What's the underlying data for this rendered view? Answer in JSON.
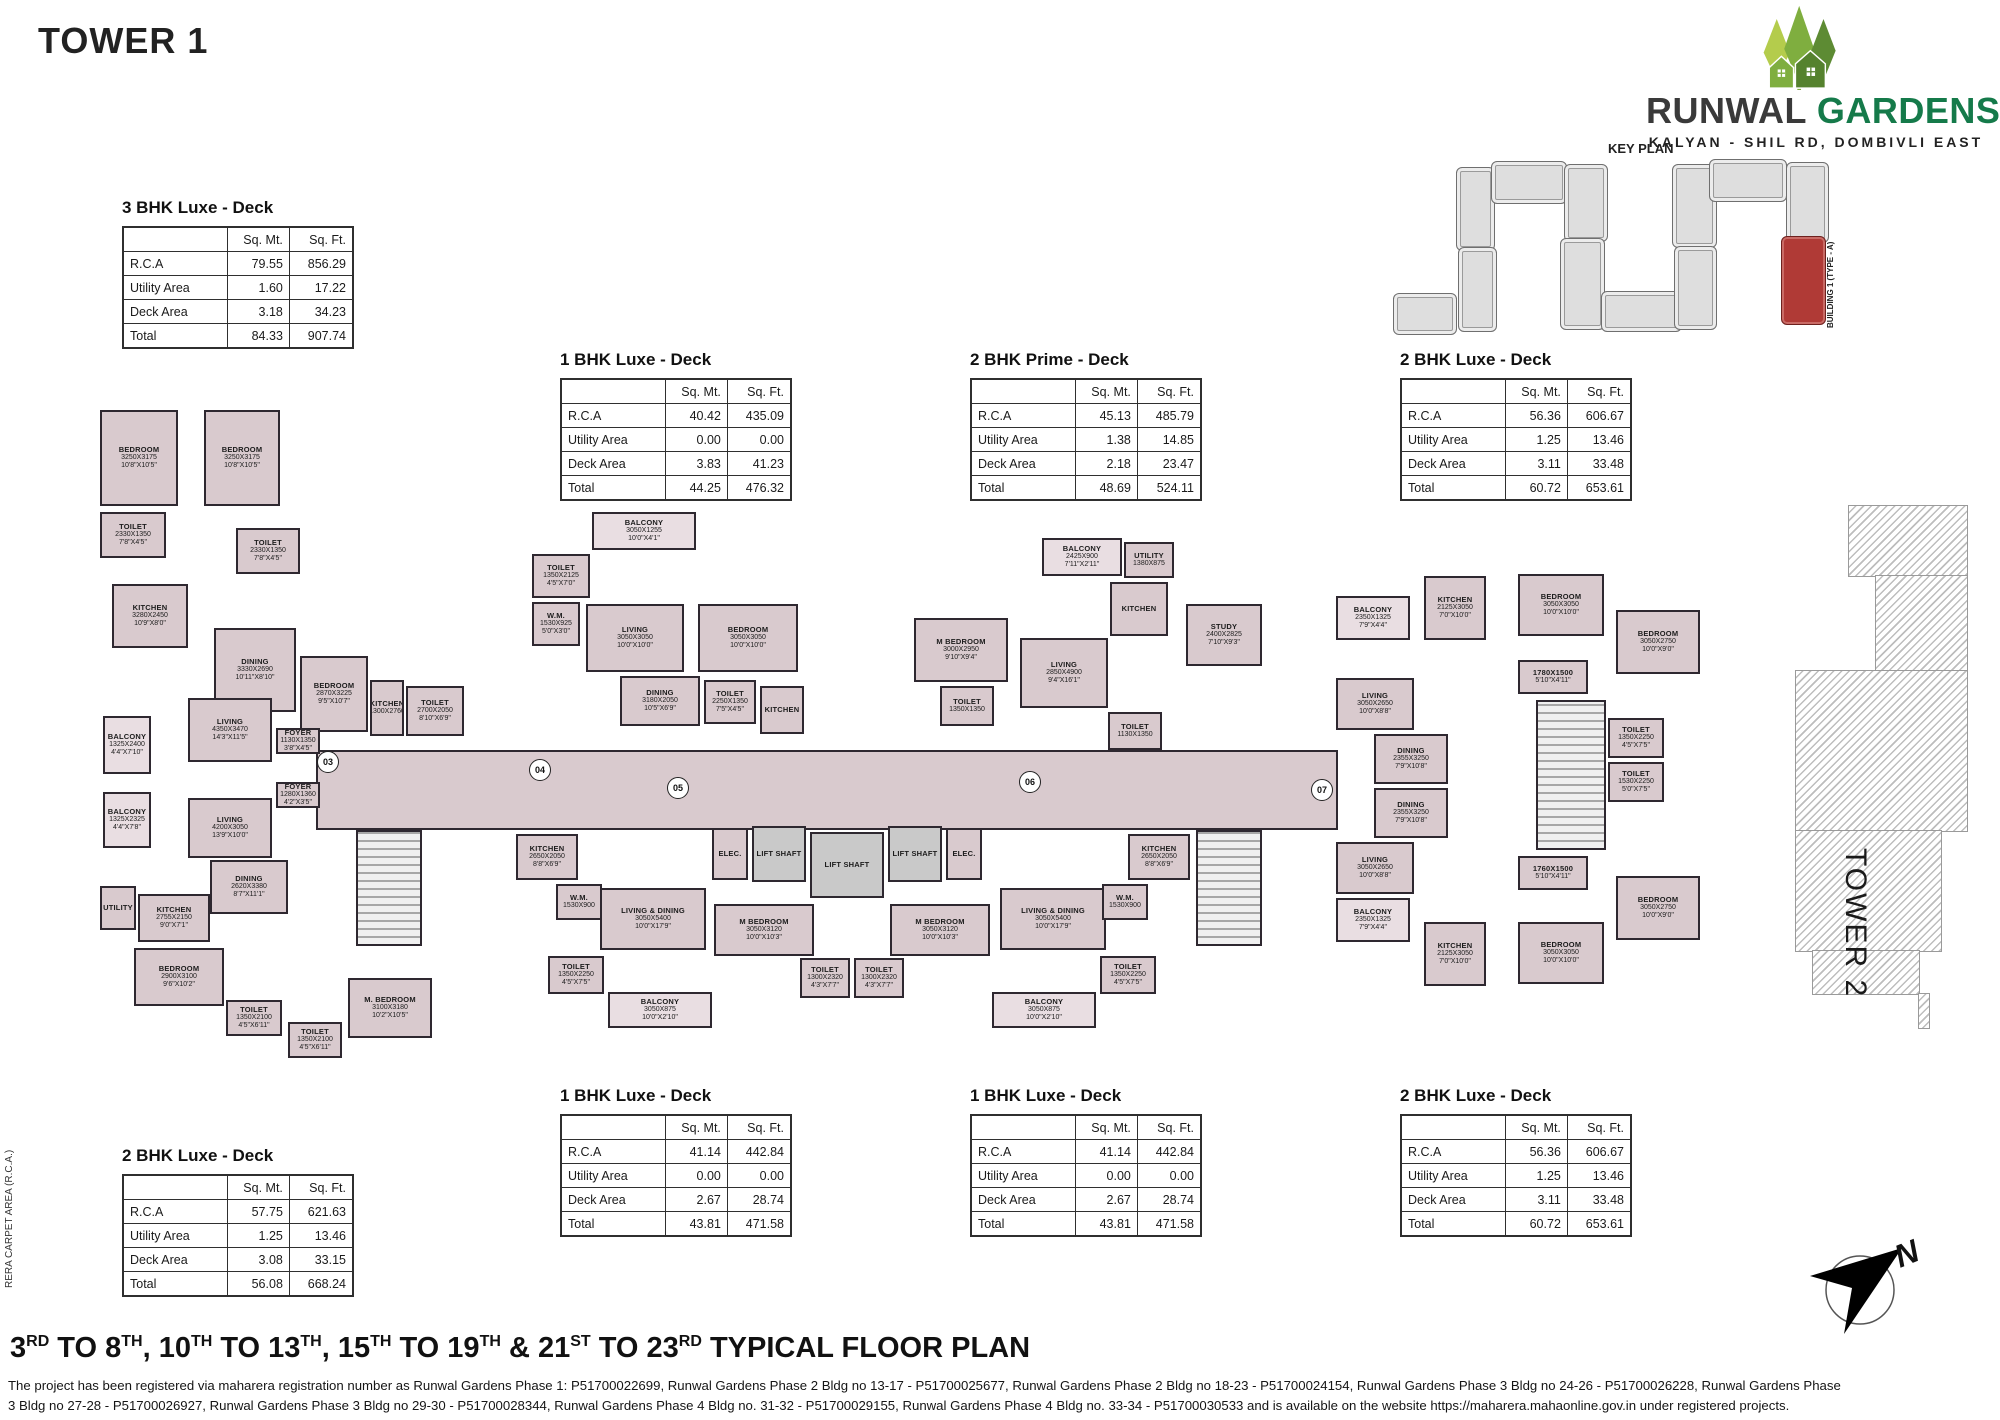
{
  "page": {
    "title": "TOWER 1"
  },
  "brand": {
    "name_primary": "RUNWAL",
    "name_secondary": "GARDENS",
    "tagline": "KALYAN - SHIL RD, DOMBIVLI EAST",
    "colors": {
      "primary_text": "#3a3a3a",
      "secondary_text": "#157a4a",
      "tree_light": "#b4cc4c",
      "tree_mid": "#7fae3f",
      "tree_dark": "#5d8b33"
    }
  },
  "key_plan": {
    "label": "KEY PLAN",
    "building_label": "BUILDING 1 (TYPE - A)",
    "highlight_color": "#b03a36",
    "blocks": [
      {
        "x": 1393,
        "y": 293,
        "w": 62,
        "h": 40
      },
      {
        "x": 1456,
        "y": 167,
        "w": 37,
        "h": 82
      },
      {
        "x": 1458,
        "y": 247,
        "w": 37,
        "h": 83
      },
      {
        "x": 1491,
        "y": 161,
        "w": 74,
        "h": 41
      },
      {
        "x": 1564,
        "y": 164,
        "w": 42,
        "h": 76
      },
      {
        "x": 1560,
        "y": 238,
        "w": 43,
        "h": 90
      },
      {
        "x": 1601,
        "y": 291,
        "w": 79,
        "h": 39
      },
      {
        "x": 1672,
        "y": 164,
        "w": 43,
        "h": 82
      },
      {
        "x": 1674,
        "y": 246,
        "w": 41,
        "h": 82
      },
      {
        "x": 1709,
        "y": 159,
        "w": 76,
        "h": 41
      },
      {
        "x": 1786,
        "y": 162,
        "w": 41,
        "h": 79
      },
      {
        "x": 1781,
        "y": 236,
        "w": 43,
        "h": 87,
        "red": true
      }
    ]
  },
  "tables": [
    {
      "title": "3 BHK Luxe - Deck",
      "headers": [
        "",
        "Sq. Mt.",
        "Sq. Ft."
      ],
      "rows": [
        [
          "R.C.A",
          "79.55",
          "856.29"
        ],
        [
          "Utility Area",
          "1.60",
          "17.22"
        ],
        [
          "Deck Area",
          "3.18",
          "34.23"
        ],
        [
          "Total",
          "84.33",
          "907.74"
        ]
      ]
    },
    {
      "title": "1 BHK Luxe - Deck",
      "headers": [
        "",
        "Sq. Mt.",
        "Sq. Ft."
      ],
      "rows": [
        [
          "R.C.A",
          "40.42",
          "435.09"
        ],
        [
          "Utility Area",
          "0.00",
          "0.00"
        ],
        [
          "Deck Area",
          "3.83",
          "41.23"
        ],
        [
          "Total",
          "44.25",
          "476.32"
        ]
      ]
    },
    {
      "title": "2 BHK Prime - Deck",
      "headers": [
        "",
        "Sq. Mt.",
        "Sq. Ft."
      ],
      "rows": [
        [
          "R.C.A",
          "45.13",
          "485.79"
        ],
        [
          "Utility Area",
          "1.38",
          "14.85"
        ],
        [
          "Deck Area",
          "2.18",
          "23.47"
        ],
        [
          "Total",
          "48.69",
          "524.11"
        ]
      ]
    },
    {
      "title": "2 BHK Luxe - Deck",
      "headers": [
        "",
        "Sq. Mt.",
        "Sq. Ft."
      ],
      "rows": [
        [
          "R.C.A",
          "56.36",
          "606.67"
        ],
        [
          "Utility Area",
          "1.25",
          "13.46"
        ],
        [
          "Deck Area",
          "3.11",
          "33.48"
        ],
        [
          "Total",
          "60.72",
          "653.61"
        ]
      ]
    },
    {
      "title": "1 BHK Luxe - Deck",
      "headers": [
        "",
        "Sq. Mt.",
        "Sq. Ft."
      ],
      "rows": [
        [
          "R.C.A",
          "41.14",
          "442.84"
        ],
        [
          "Utility Area",
          "0.00",
          "0.00"
        ],
        [
          "Deck Area",
          "2.67",
          "28.74"
        ],
        [
          "Total",
          "43.81",
          "471.58"
        ]
      ]
    },
    {
      "title": "1 BHK Luxe - Deck",
      "headers": [
        "",
        "Sq. Mt.",
        "Sq. Ft."
      ],
      "rows": [
        [
          "R.C.A",
          "41.14",
          "442.84"
        ],
        [
          "Utility Area",
          "0.00",
          "0.00"
        ],
        [
          "Deck Area",
          "2.67",
          "28.74"
        ],
        [
          "Total",
          "43.81",
          "471.58"
        ]
      ]
    },
    {
      "title": "2 BHK Luxe - Deck",
      "headers": [
        "",
        "Sq. Mt.",
        "Sq. Ft."
      ],
      "rows": [
        [
          "R.C.A",
          "56.36",
          "606.67"
        ],
        [
          "Utility Area",
          "1.25",
          "13.46"
        ],
        [
          "Deck Area",
          "3.11",
          "33.48"
        ],
        [
          "Total",
          "60.72",
          "653.61"
        ]
      ]
    },
    {
      "title": "2 BHK Luxe - Deck",
      "headers": [
        "",
        "Sq. Mt.",
        "Sq. Ft."
      ],
      "rows": [
        [
          "R.C.A",
          "57.75",
          "621.63"
        ],
        [
          "Utility Area",
          "1.25",
          "13.46"
        ],
        [
          "Deck Area",
          "3.08",
          "33.15"
        ],
        [
          "Total",
          "56.08",
          "668.24"
        ]
      ]
    }
  ],
  "floor_plan": {
    "tower2_label": "TOWER 2",
    "rera_note": "RERA CARPET AREA (R.C.A.)",
    "room_fill": "#d9cace",
    "rooms": [
      [
        "",
        "",
        "",
        316,
        750,
        1022,
        80,
        "c"
      ],
      [
        "BEDROOM",
        "3250X3175",
        "10'8\"X10'5\"",
        100,
        410,
        78,
        96,
        "r"
      ],
      [
        "BEDROOM",
        "3250X3175",
        "10'8\"X10'5\"",
        204,
        410,
        76,
        96,
        "r"
      ],
      [
        "TOILET",
        "2330X1350",
        "7'8\"X4'5\"",
        100,
        512,
        66,
        46,
        "r"
      ],
      [
        "TOILET",
        "2330X1350",
        "7'8\"X4'5\"",
        236,
        528,
        64,
        46,
        "r"
      ],
      [
        "KITCHEN",
        "3280X2450",
        "10'9\"X8'0\"",
        112,
        584,
        76,
        64,
        "r"
      ],
      [
        "DINING",
        "3330X2690",
        "10'11\"X8'10\"",
        214,
        628,
        82,
        84,
        "r"
      ],
      [
        "BEDROOM",
        "2870X3225",
        "9'5\"X10'7\"",
        300,
        656,
        68,
        76,
        "r"
      ],
      [
        "KITCHEN",
        "1300X2760",
        "",
        370,
        680,
        34,
        56,
        "r"
      ],
      [
        "TOILET",
        "2700X2050",
        "8'10\"X6'9\"",
        406,
        686,
        58,
        50,
        "r"
      ],
      [
        "BALCONY",
        "1325X2400",
        "4'4\"X7'10\"",
        103,
        716,
        48,
        58,
        "b"
      ],
      [
        "LIVING",
        "4350X3470",
        "14'3\"X11'5\"",
        188,
        698,
        84,
        64,
        "r"
      ],
      [
        "FOYER",
        "1130X1350",
        "3'8\"X4'5\"",
        276,
        728,
        44,
        26,
        "r"
      ],
      [
        "FOYER",
        "1280X1360",
        "4'2\"X3'5\"",
        276,
        782,
        44,
        26,
        "r"
      ],
      [
        "BALCONY",
        "1325X2325",
        "4'4\"X7'8\"",
        103,
        792,
        48,
        56,
        "b"
      ],
      [
        "LIVING",
        "4200X3050",
        "13'9\"X10'0\"",
        188,
        798,
        84,
        60,
        "r"
      ],
      [
        "DINING",
        "2620X3380",
        "8'7\"X11'1\"",
        210,
        860,
        78,
        54,
        "r"
      ],
      [
        "UTILITY",
        "",
        "",
        100,
        886,
        36,
        44,
        "r"
      ],
      [
        "KITCHEN",
        "2755X2150",
        "9'0\"X7'1\"",
        138,
        894,
        72,
        48,
        "r"
      ],
      [
        "BEDROOM",
        "2900X3100",
        "9'6\"X10'2\"",
        134,
        948,
        90,
        58,
        "r"
      ],
      [
        "TOILET",
        "1350X2100",
        "4'5\"X6'11\"",
        226,
        1000,
        56,
        36,
        "r"
      ],
      [
        "TOILET",
        "1350X2100",
        "4'5\"X6'11\"",
        288,
        1022,
        54,
        36,
        "r"
      ],
      [
        "M. BEDROOM",
        "3100X3180",
        "10'2\"X10'5\"",
        348,
        978,
        84,
        60,
        "r"
      ],
      [
        "",
        "",
        "",
        356,
        830,
        66,
        116,
        "s"
      ],
      [
        "BALCONY",
        "3050X1255",
        "10'0\"X4'1\"",
        592,
        512,
        104,
        38,
        "b"
      ],
      [
        "TOILET",
        "1350X2125",
        "4'5\"X7'0\"",
        532,
        554,
        58,
        44,
        "r"
      ],
      [
        "W.M.",
        "1530X925",
        "5'0\"X3'0\"",
        532,
        602,
        48,
        44,
        "r"
      ],
      [
        "LIVING",
        "3050X3050",
        "10'0\"X10'0\"",
        586,
        604,
        98,
        68,
        "r"
      ],
      [
        "BEDROOM",
        "3050X3050",
        "10'0\"X10'0\"",
        698,
        604,
        100,
        68,
        "r"
      ],
      [
        "DINING",
        "3180X2050",
        "10'5\"X6'9\"",
        620,
        676,
        80,
        50,
        "r"
      ],
      [
        "TOILET",
        "2250X1350",
        "7'5\"X4'5\"",
        704,
        680,
        52,
        44,
        "r"
      ],
      [
        "KITCHEN",
        "",
        "",
        760,
        686,
        44,
        48,
        "r"
      ],
      [
        "BALCONY",
        "2425X900",
        "7'11\"X2'11\"",
        1042,
        538,
        80,
        38,
        "b"
      ],
      [
        "UTILITY",
        "1380X875",
        "",
        1124,
        542,
        50,
        36,
        "r"
      ],
      [
        "M BEDROOM",
        "3000X2950",
        "9'10\"X9'4\"",
        914,
        618,
        94,
        64,
        "r"
      ],
      [
        "LIVING",
        "2850X4900",
        "9'4\"X16'1\"",
        1020,
        638,
        88,
        70,
        "r"
      ],
      [
        "KITCHEN",
        "",
        "",
        1110,
        582,
        58,
        54,
        "r"
      ],
      [
        "STUDY",
        "2400X2825",
        "7'10\"X9'3\"",
        1186,
        604,
        76,
        62,
        "r"
      ],
      [
        "TOILET",
        "1350X1350",
        "",
        940,
        686,
        54,
        40,
        "r"
      ],
      [
        "TOILET",
        "1130X1350",
        "",
        1108,
        712,
        54,
        38,
        "r"
      ],
      [
        "BALCONY",
        "2350X1325",
        "7'9\"X4'4\"",
        1336,
        596,
        74,
        44,
        "b"
      ],
      [
        "KITCHEN",
        "2125X3050",
        "7'0\"X10'0\"",
        1424,
        576,
        62,
        64,
        "r"
      ],
      [
        "BEDROOM",
        "3050X3050",
        "10'0\"X10'0\"",
        1518,
        574,
        86,
        62,
        "r"
      ],
      [
        "BEDROOM",
        "3050X2750",
        "10'0\"X9'0\"",
        1616,
        610,
        84,
        64,
        "r"
      ],
      [
        "LIVING",
        "3050X2650",
        "10'0\"X8'8\"",
        1336,
        678,
        78,
        52,
        "r"
      ],
      [
        "DINING",
        "2355X3250",
        "7'9\"X10'8\"",
        1374,
        734,
        74,
        50,
        "r"
      ],
      [
        "1780X1500",
        "",
        "5'10\"X4'11\"",
        1518,
        660,
        70,
        34,
        "r"
      ],
      [
        "TOILET",
        "1350X2250",
        "4'5\"X7'5\"",
        1608,
        718,
        56,
        40,
        "r"
      ],
      [
        "TOILET",
        "1530X2250",
        "5'0\"X7'5\"",
        1608,
        762,
        56,
        40,
        "r"
      ],
      [
        "",
        "",
        "",
        1536,
        700,
        70,
        150,
        "s"
      ],
      [
        "DINING",
        "2355X3250",
        "7'9\"X10'8\"",
        1374,
        788,
        74,
        50,
        "r"
      ],
      [
        "LIVING",
        "3050X2650",
        "10'0\"X8'8\"",
        1336,
        842,
        78,
        52,
        "r"
      ],
      [
        "1760X1500",
        "",
        "5'10\"X4'11\"",
        1518,
        856,
        70,
        34,
        "r"
      ],
      [
        "BEDROOM",
        "3050X2750",
        "10'0\"X9'0\"",
        1616,
        876,
        84,
        64,
        "r"
      ],
      [
        "BALCONY",
        "2350X1325",
        "7'9\"X4'4\"",
        1336,
        898,
        74,
        44,
        "b"
      ],
      [
        "KITCHEN",
        "2125X3050",
        "7'0\"X10'0\"",
        1424,
        922,
        62,
        64,
        "r"
      ],
      [
        "BEDROOM",
        "3050X3050",
        "10'0\"X10'0\"",
        1518,
        922,
        86,
        62,
        "r"
      ],
      [
        "KITCHEN",
        "2650X2050",
        "8'8\"X6'9\"",
        516,
        834,
        62,
        46,
        "r"
      ],
      [
        "ELEC.",
        "",
        "",
        712,
        828,
        36,
        52,
        "r"
      ],
      [
        "LIFT SHAFT",
        "",
        "",
        752,
        826,
        54,
        56,
        "l"
      ],
      [
        "LIFT SHAFT",
        "",
        "",
        810,
        832,
        74,
        66,
        "l"
      ],
      [
        "LIFT SHAFT",
        "",
        "",
        888,
        826,
        54,
        56,
        "l"
      ],
      [
        "ELEC.",
        "",
        "",
        946,
        828,
        36,
        52,
        "r"
      ],
      [
        "W.M.",
        "1530X900",
        "",
        556,
        884,
        46,
        36,
        "r"
      ],
      [
        "LIVING & DINING",
        "3050X5400",
        "10'0\"X17'9\"",
        600,
        888,
        106,
        62,
        "r"
      ],
      [
        "M BEDROOM",
        "3050X3120",
        "10'0\"X10'3\"",
        714,
        904,
        100,
        52,
        "r"
      ],
      [
        "TOILET",
        "1350X2250",
        "4'5\"X7'5\"",
        548,
        956,
        56,
        38,
        "r"
      ],
      [
        "BALCONY",
        "3050X875",
        "10'0\"X2'10\"",
        608,
        992,
        104,
        36,
        "b"
      ],
      [
        "TOILET",
        "1300X2320",
        "4'3\"X7'7\"",
        800,
        958,
        50,
        40,
        "r"
      ],
      [
        "TOILET",
        "1300X2320",
        "4'3\"X7'7\"",
        854,
        958,
        50,
        40,
        "r"
      ],
      [
        "M BEDROOM",
        "3050X3120",
        "10'0\"X10'3\"",
        890,
        904,
        100,
        52,
        "r"
      ],
      [
        "LIVING & DINING",
        "3050X5400",
        "10'0\"X17'9\"",
        1000,
        888,
        106,
        62,
        "r"
      ],
      [
        "W.M.",
        "1530X900",
        "",
        1102,
        884,
        46,
        36,
        "r"
      ],
      [
        "KITCHEN",
        "2650X2050",
        "8'8\"X6'9\"",
        1128,
        834,
        62,
        46,
        "r"
      ],
      [
        "TOILET",
        "1350X2250",
        "4'5\"X7'5\"",
        1100,
        956,
        56,
        38,
        "r"
      ],
      [
        "BALCONY",
        "3050X875",
        "10'0\"X2'10\"",
        992,
        992,
        104,
        36,
        "b"
      ],
      [
        "",
        "",
        "",
        1196,
        830,
        66,
        116,
        "s"
      ]
    ],
    "markers": [
      {
        "label": "03",
        "x": 328,
        "y": 762
      },
      {
        "label": "04",
        "x": 540,
        "y": 770
      },
      {
        "label": "05",
        "x": 678,
        "y": 788
      },
      {
        "label": "06",
        "x": 1030,
        "y": 782
      },
      {
        "label": "07",
        "x": 1322,
        "y": 790
      }
    ]
  },
  "compass": {
    "label": "N"
  },
  "footer": {
    "title_parts": [
      {
        "t": "3",
        "s": "RD"
      },
      {
        "t": " TO 8",
        "s": "TH"
      },
      {
        "t": ", 10",
        "s": "TH"
      },
      {
        "t": " TO 13",
        "s": "TH"
      },
      {
        "t": ", 15",
        "s": "TH"
      },
      {
        "t": " TO 19",
        "s": "TH"
      },
      {
        "t": " & 21",
        "s": "ST"
      },
      {
        "t": " TO 23",
        "s": "RD"
      },
      {
        "t": " TYPICAL FLOOR PLAN",
        "s": ""
      }
    ],
    "legal_line1": "The project has been registered via maharera registration number as Runwal Gardens Phase 1: P51700022699, Runwal Gardens Phase 2 Bldg no 13-17 - P51700025677, Runwal Gardens Phase 2 Bldg no 18-23 - P51700024154, Runwal Gardens Phase 3 Bldg no 24-26 - P51700026228, Runwal Gardens Phase",
    "legal_line2": "3 Bldg no 27-28 - P51700026927, Runwal Gardens Phase 3 Bldg no 29-30 - P51700028344, Runwal Gardens Phase 4 Bldg no. 31-32 - P51700029155, Runwal Gardens Phase 4 Bldg no. 33-34 - P51700030533 and is available on the website https://maharera.mahaonline.gov.in under registered projects."
  }
}
